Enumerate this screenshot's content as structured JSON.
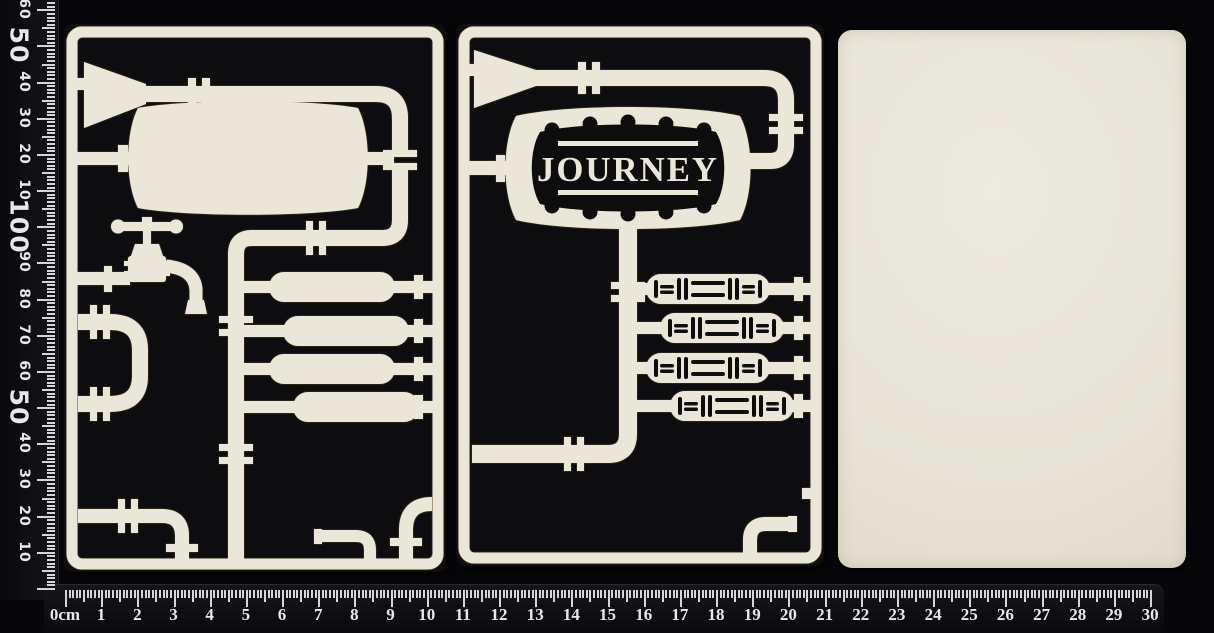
{
  "scene_colors": {
    "chipboard": "#eae6d8",
    "laser_burn_edge": "#8a6a35",
    "chipboard_black_face": "#0d0d10",
    "background": "#07070a",
    "ruler_tick": "#d6d6da",
    "ruler_text": "#e8e8ec"
  },
  "banner": {
    "text": "JOURNEY"
  },
  "vertical_ruler": {
    "labels": [
      {
        "cm": 1,
        "text": "10",
        "big": false
      },
      {
        "cm": 2,
        "text": "20",
        "big": false
      },
      {
        "cm": 3,
        "text": "30",
        "big": false
      },
      {
        "cm": 4,
        "text": "40",
        "big": false
      },
      {
        "cm": 5,
        "text": "50",
        "big": true
      },
      {
        "cm": 6,
        "text": "60",
        "big": false
      },
      {
        "cm": 7,
        "text": "70",
        "big": false
      },
      {
        "cm": 8,
        "text": "80",
        "big": false
      },
      {
        "cm": 9,
        "text": "90",
        "big": false
      },
      {
        "cm": 10,
        "text": "100",
        "big": true
      },
      {
        "cm": 11,
        "text": "10",
        "big": false
      },
      {
        "cm": 12,
        "text": "20",
        "big": false
      },
      {
        "cm": 13,
        "text": "30",
        "big": false
      },
      {
        "cm": 14,
        "text": "40",
        "big": false
      },
      {
        "cm": 15,
        "text": "50",
        "big": true
      },
      {
        "cm": 16,
        "text": "60",
        "big": false
      }
    ]
  },
  "horizontal_ruler": {
    "labels": [
      "0cm",
      "1",
      "2",
      "3",
      "4",
      "5",
      "6",
      "7",
      "8",
      "9",
      "10",
      "11",
      "12",
      "13",
      "14",
      "15",
      "16",
      "17",
      "18",
      "19",
      "20",
      "21",
      "22",
      "23",
      "24",
      "25",
      "26",
      "27",
      "28",
      "29",
      "30"
    ]
  }
}
